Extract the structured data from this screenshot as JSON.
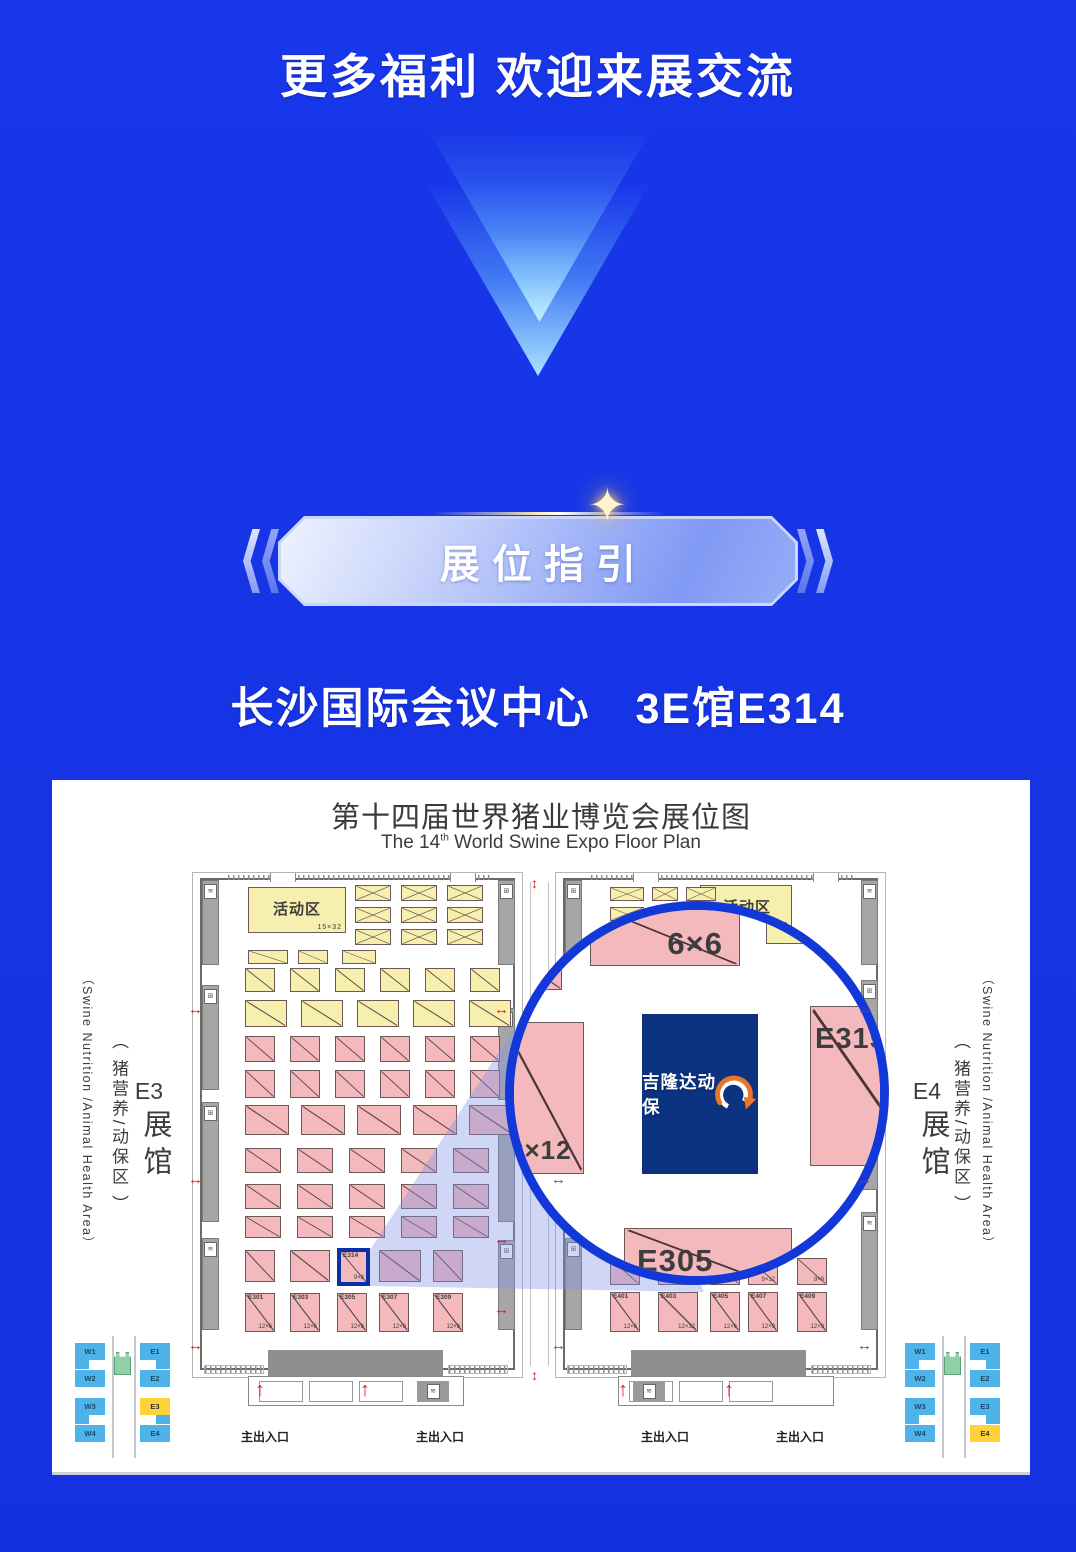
{
  "page": {
    "title": "更多福利 欢迎来展交流",
    "badge": "展位指引",
    "venue": "长沙国际会议中心　3E馆E314"
  },
  "card": {
    "title_cn": "第十四届世界猪业博览会展位图",
    "title_en": {
      "pre": "The 14",
      "sup": "th",
      "post": " World Swine Expo Floor Plan"
    },
    "hall_left": {
      "code": "E3",
      "hall": "展馆",
      "zone": "（ 猪营养/动保区 ）",
      "zone_en": "（Swine Nutrition /Animal Health Area）"
    },
    "hall_right": {
      "code": "E4",
      "hall": "展馆",
      "zone": "（ 猪营养/动保区 ）",
      "zone_en": "（Swine Nutrition /Animal Health Area）"
    },
    "activity": {
      "label": "活动区",
      "size": "15×32"
    },
    "entrance_label": "主出入口",
    "highlight_booth": {
      "code": "E314",
      "size": "9×6"
    },
    "left_bottom_row": [
      {
        "code": "E301",
        "size": "12×6"
      },
      {
        "code": "E303",
        "size": "12×6"
      },
      {
        "code": "E305",
        "size": "12×6"
      },
      {
        "code": "E307",
        "size": "12×6"
      },
      {
        "code": "E309",
        "size": "12×6"
      }
    ],
    "right_bottom_row": [
      {
        "code": "E401",
        "size": "12×6"
      },
      {
        "code": "E403",
        "size": "12×12"
      },
      {
        "code": "E405",
        "size": "12×6"
      },
      {
        "code": "E407",
        "size": "12×9"
      },
      {
        "code": "E409",
        "size": "12×9"
      }
    ],
    "right_partial_row_sizes": [
      "",
      "",
      "",
      "9×12",
      "9×9"
    ],
    "magnifier": {
      "booth_top": "6×6",
      "booth_right": "E315",
      "booth_left": "9×12",
      "booth_bottom": "E305",
      "brand": "吉隆达动保"
    },
    "minimap": {
      "west": [
        "W1",
        "W2",
        "W3",
        "W4"
      ],
      "east": [
        "E1",
        "E2",
        "E3",
        "E4"
      ],
      "left_highlight": "E3",
      "right_highlight": "E4"
    }
  },
  "colors": {
    "background_blue": "#1735E6",
    "circle_border_blue": "#1238D8",
    "booth_pink": "#F4B9BC",
    "booth_yellow": "#F6EFAD",
    "brand_navy": "#0C3380",
    "logo_orange": "#E8762A",
    "minimap_blue": "#4DB3E8",
    "minimap_highlight_yellow": "#FFD23A",
    "arrow_red": "#E01A1A"
  }
}
